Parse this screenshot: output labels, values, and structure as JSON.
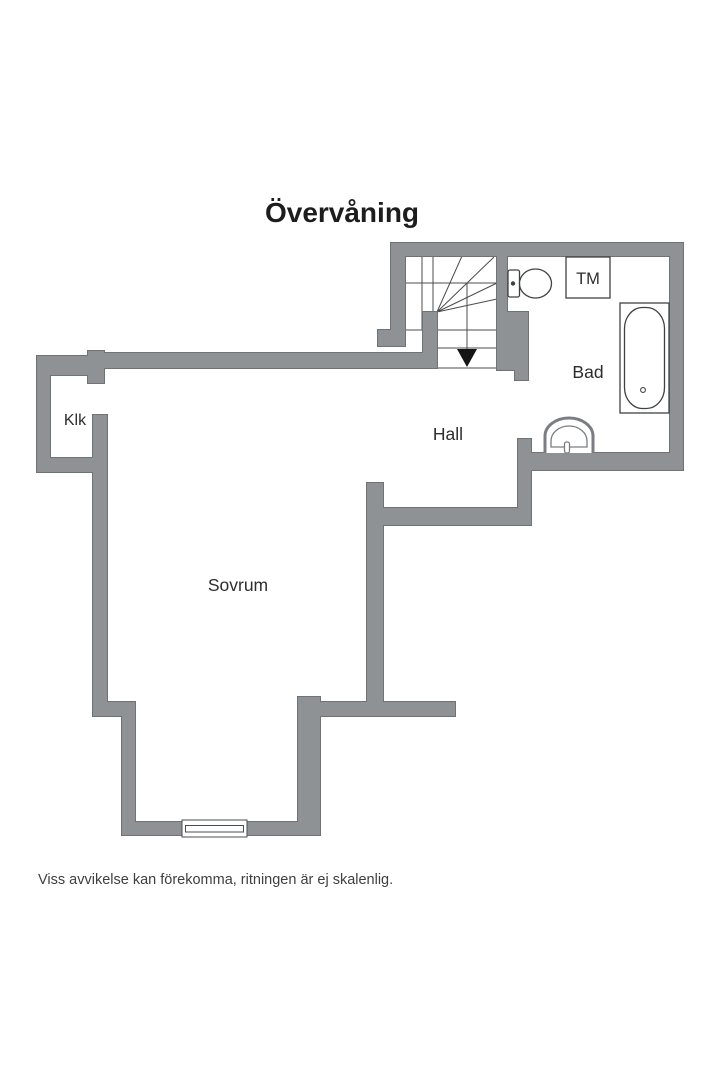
{
  "title": "Övervåning",
  "disclaimer": "Viss avvikelse kan förekomma, ritningen är ej skalenlig.",
  "rooms": {
    "closet": "Klk",
    "hall": "Hall",
    "bathroom": "Bad",
    "bedroom": "Sovrum"
  },
  "appliances": {
    "washing_machine": "TM"
  },
  "colors": {
    "wall": "#8e9295",
    "wall_outline": "#6f7376",
    "stair_line": "#4a4d4f",
    "fixture_line": "#3f4244",
    "sink_line": "#7a7e82",
    "text": "#2d2d2d",
    "bg": "#ffffff"
  }
}
